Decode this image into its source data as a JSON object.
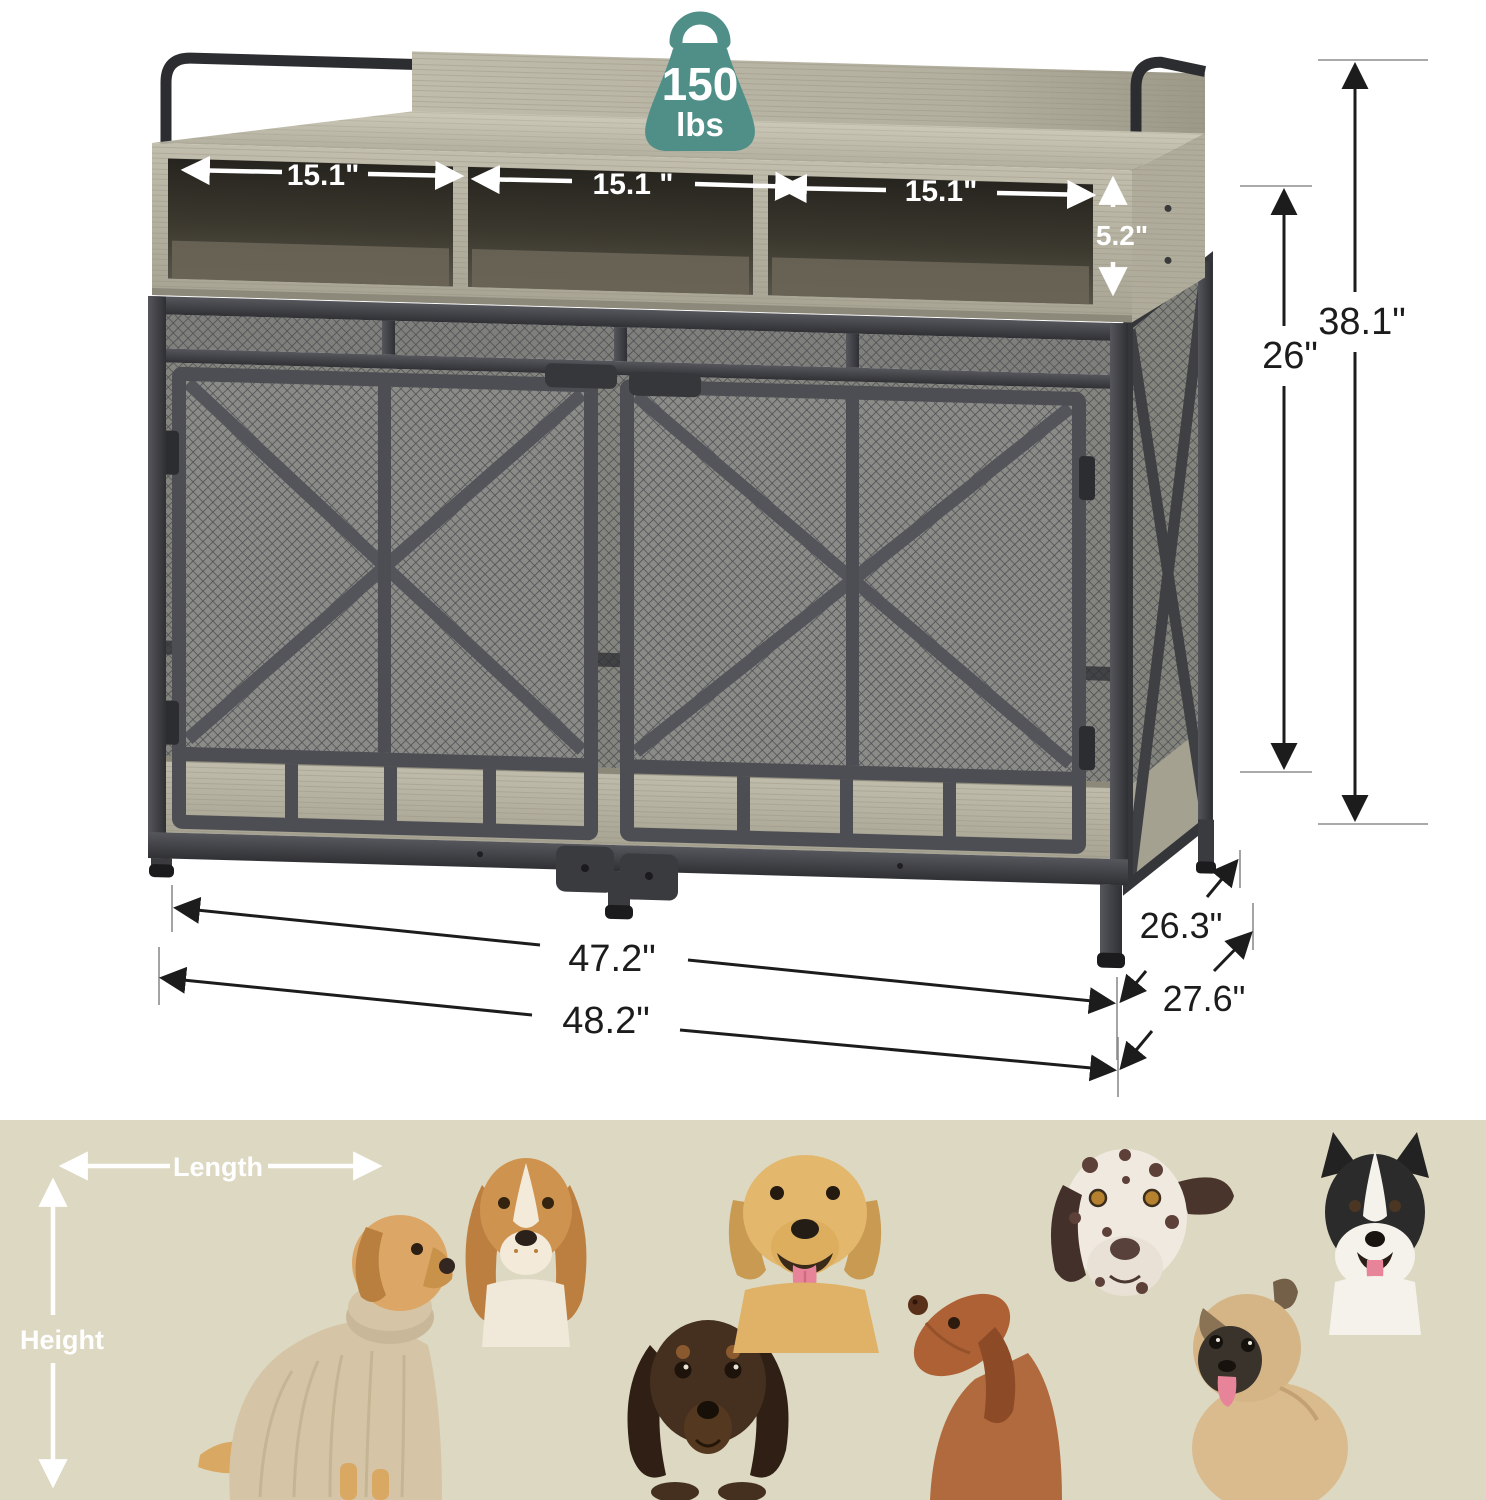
{
  "weight_badge": {
    "value": "150",
    "unit": "lbs",
    "color": "#4f8f88"
  },
  "dimensions": {
    "cubby_1": "15.1\"",
    "cubby_2": "15.1 \"",
    "cubby_3": "15.1\"",
    "cubby_height": "5.2\"",
    "overall_height": "38.1\"",
    "crate_inner_height": "26\"",
    "inner_width": "47.2\"",
    "overall_width": "48.2\"",
    "inner_depth": "26.3\"",
    "overall_depth": "27.6\""
  },
  "size_guide": {
    "length_label": "Length",
    "height_label": "Height",
    "background_color": "#ddd8c2",
    "dogs": [
      {
        "name": "dog-wearing-sweater"
      },
      {
        "name": "cocker-spaniel"
      },
      {
        "name": "long-haired-dachshund"
      },
      {
        "name": "yellow-labrador"
      },
      {
        "name": "vizsla-looking-up"
      },
      {
        "name": "dalmatian"
      },
      {
        "name": "pug"
      },
      {
        "name": "border-collie"
      }
    ]
  },
  "colors": {
    "metal": "#3a3b3f",
    "wood_light": "#c6c2b1",
    "wood_mid": "#b2ae9e",
    "mesh_line": "#4e4f53",
    "annotation": "#1c1c1c"
  }
}
